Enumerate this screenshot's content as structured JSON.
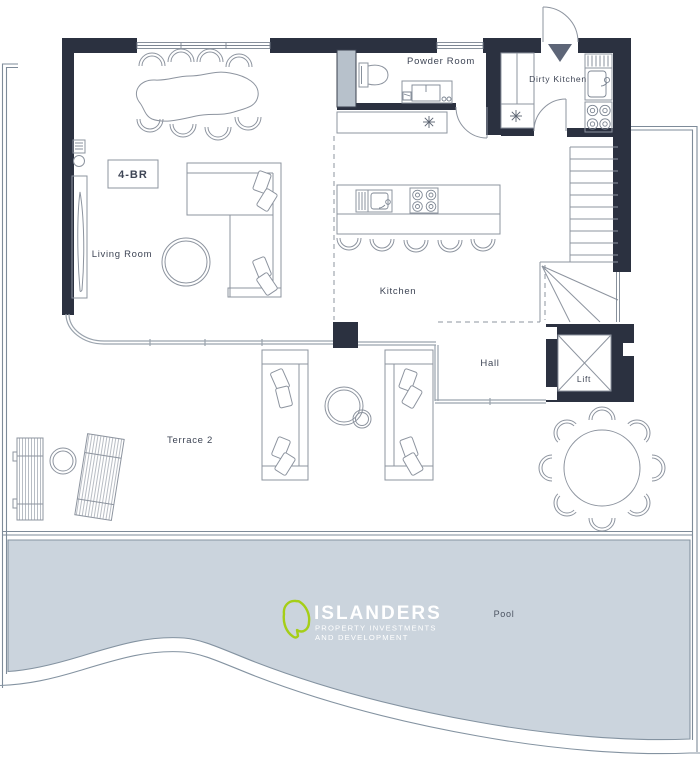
{
  "labels": {
    "powder_room": "Powder Room",
    "dirty_kitchen": "Dirty Kitchen",
    "living_room": "Living Room",
    "kitchen": "Kitchen",
    "hall": "Hall",
    "lift": "Lift",
    "terrace": "Terrace 2",
    "pool": "Pool",
    "unit_type": "4-BR"
  },
  "branding": {
    "name": "ISLANDERS",
    "tagline_line1": "PROPERTY INVESTMENTS",
    "tagline_line2": "AND DEVELOPMENT",
    "logo_green": "#a5ce17"
  },
  "colors": {
    "wall": "#2b3140",
    "pool_fill": "#cbd4dd",
    "pool_stroke": "#8493a1",
    "entry_arrow": "#5d6577",
    "glass_panel": "#b7c1cb",
    "line": "#8d949f",
    "text": "#3e4555"
  }
}
